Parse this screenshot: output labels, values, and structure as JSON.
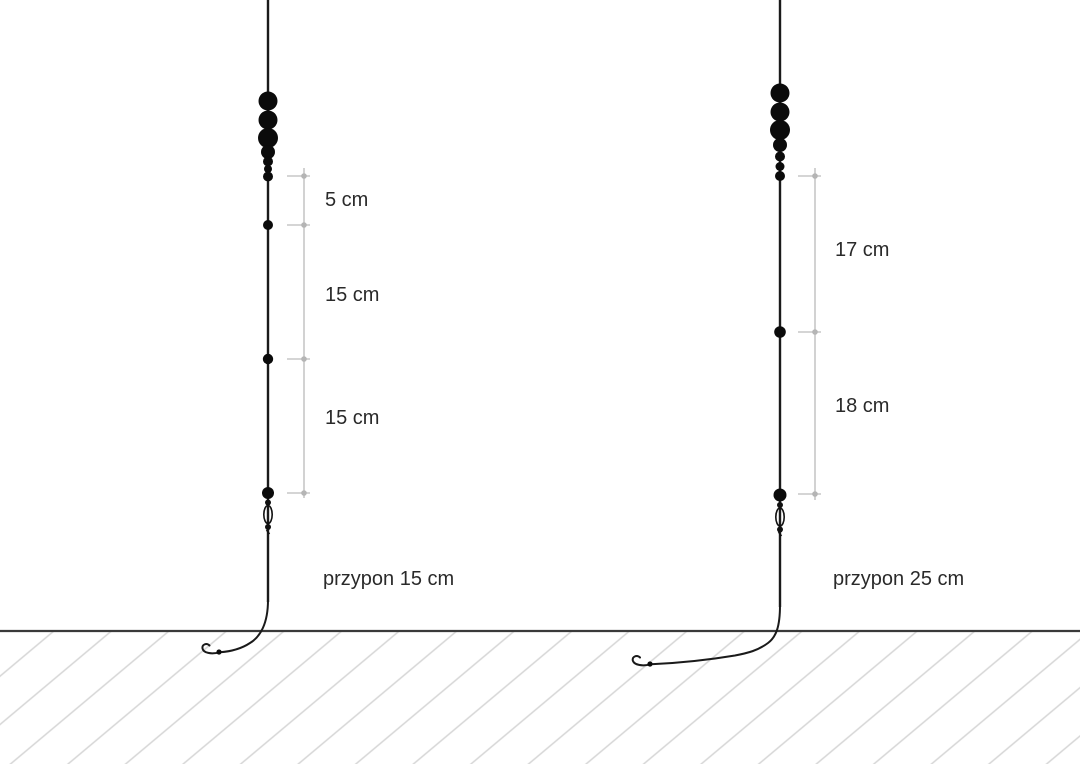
{
  "diagram": {
    "kind": "fishing-rig-comparison",
    "rigs": [
      {
        "id": "left",
        "measurements": [
          "5 cm",
          "15 cm",
          "15 cm"
        ],
        "leader_label": "przypon 15 cm"
      },
      {
        "id": "right",
        "measurements": [
          "17 cm",
          "18 cm"
        ],
        "leader_label": "przypon 25 cm"
      }
    ],
    "colors": {
      "background": "#ffffff",
      "line": "#1a1a1a",
      "shot": "#0b0b0b",
      "bracket": "#c7c7c7",
      "bracket_dot": "#b5b5b5",
      "ground_line": "#3a3a3a",
      "hatch": "#d6d6d6",
      "text": "#2a2a2a"
    }
  }
}
